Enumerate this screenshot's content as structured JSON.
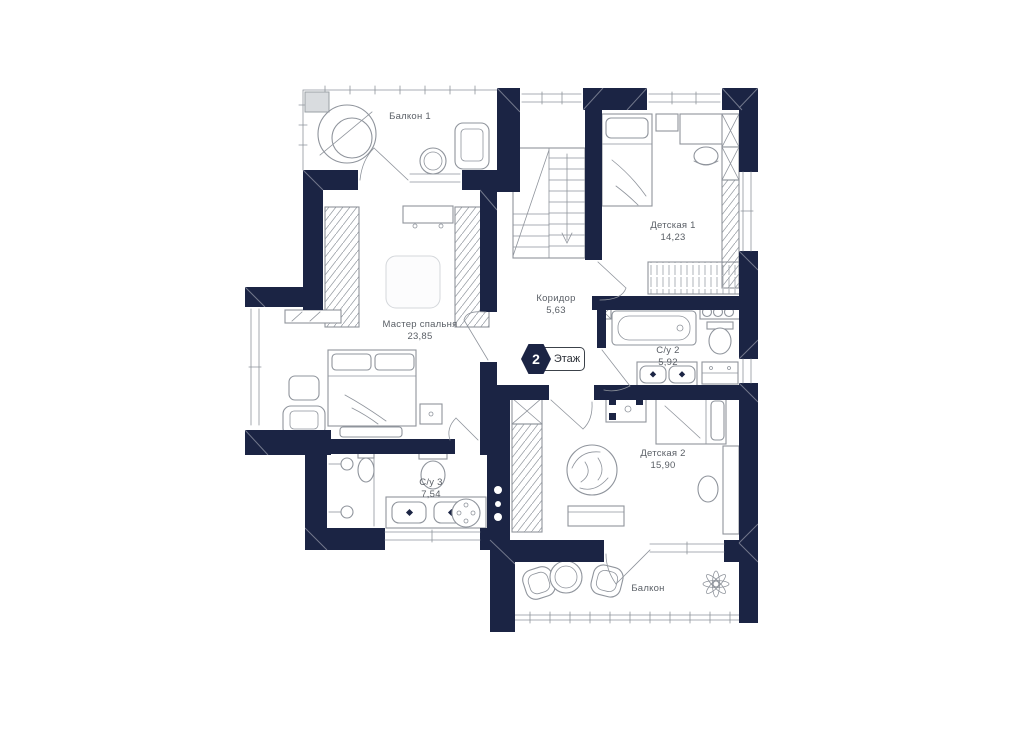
{
  "floor_badge": {
    "number": "2",
    "label": "Этаж"
  },
  "rooms": [
    {
      "name": "Балкон 1",
      "area": ""
    },
    {
      "name": "Мастер спальня",
      "area": "23,85"
    },
    {
      "name": "Коридор",
      "area": "5,63"
    },
    {
      "name": "Детская 1",
      "area": "14,23"
    },
    {
      "name": "С/у 2",
      "area": "5,92"
    },
    {
      "name": "С/у 3",
      "area": "7,54"
    },
    {
      "name": "Детская 2",
      "area": "15,90"
    },
    {
      "name": "Балкон",
      "area": ""
    }
  ],
  "colors": {
    "wall": "#1b2444",
    "line": "#8f949c",
    "label": "#5a5f66",
    "background": "#ffffff"
  }
}
